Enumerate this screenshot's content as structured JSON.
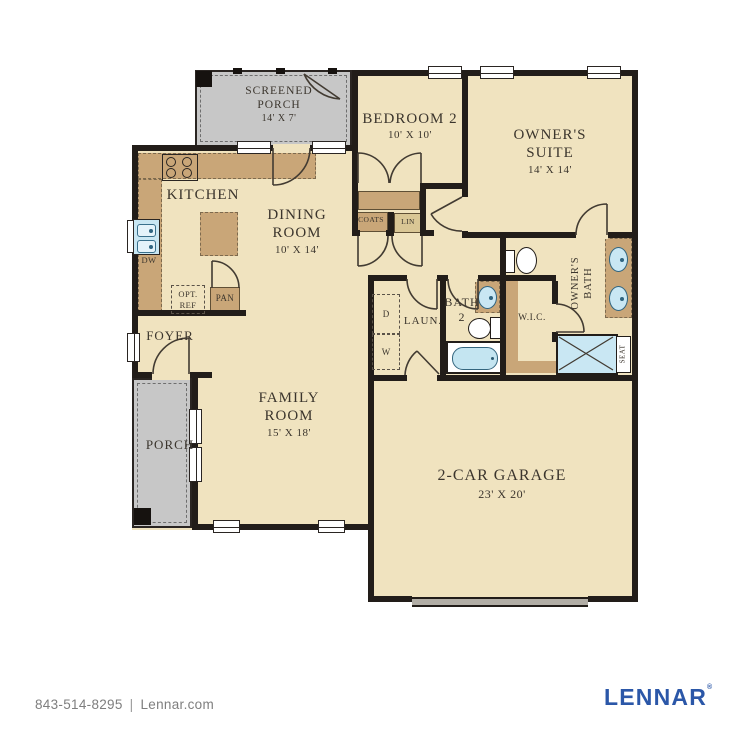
{
  "rooms": {
    "screened_porch": {
      "line1": "SCREENED",
      "line2": "PORCH",
      "dims": "14' X 7'"
    },
    "bedroom2": {
      "line1": "BEDROOM 2",
      "dims": "10' X 10'"
    },
    "owners_suite": {
      "line1": "OWNER'S",
      "line2": "SUITE",
      "dims": "14' X 14'"
    },
    "kitchen": {
      "line1": "KITCHEN"
    },
    "dining": {
      "line1": "DINING",
      "line2": "ROOM",
      "dims": "10' X 14'"
    },
    "family": {
      "line1": "FAMILY",
      "line2": "ROOM",
      "dims": "15' X 18'"
    },
    "foyer": {
      "line1": "FOYER"
    },
    "porch": {
      "line1": "PORCH"
    },
    "garage": {
      "line1": "2-CAR GARAGE",
      "dims": "23' X 20'"
    },
    "laundry": {
      "line1": "LAUN."
    },
    "bath2": {
      "line1": "BATH",
      "line2": "2"
    },
    "wic": {
      "line1": "W.I.C."
    },
    "owners_bath": {
      "line1": "OWNER'S",
      "line2": "BATH"
    }
  },
  "fixtures": {
    "coats": "COATS",
    "linen": "LIN",
    "pantry": "PAN",
    "opt_ref_line1": "OPT.",
    "opt_ref_line2": "REF",
    "dishwasher": "DW",
    "dryer": "D",
    "washer": "W",
    "seat": "SEAT"
  },
  "footer": {
    "phone": "843-514-8295",
    "separator": "|",
    "website": "Lennar.com",
    "logo": "LENNAR",
    "registered": "®"
  },
  "colors": {
    "floor": "#F0E3BF",
    "porch_gray": "#C7C7C7",
    "wall": "#221D19",
    "cabinet": "#C9A678",
    "fixture_blue": "#C9E7F3",
    "lennar_blue": "#2B57A8",
    "footer_text": "#7E7E7E"
  }
}
